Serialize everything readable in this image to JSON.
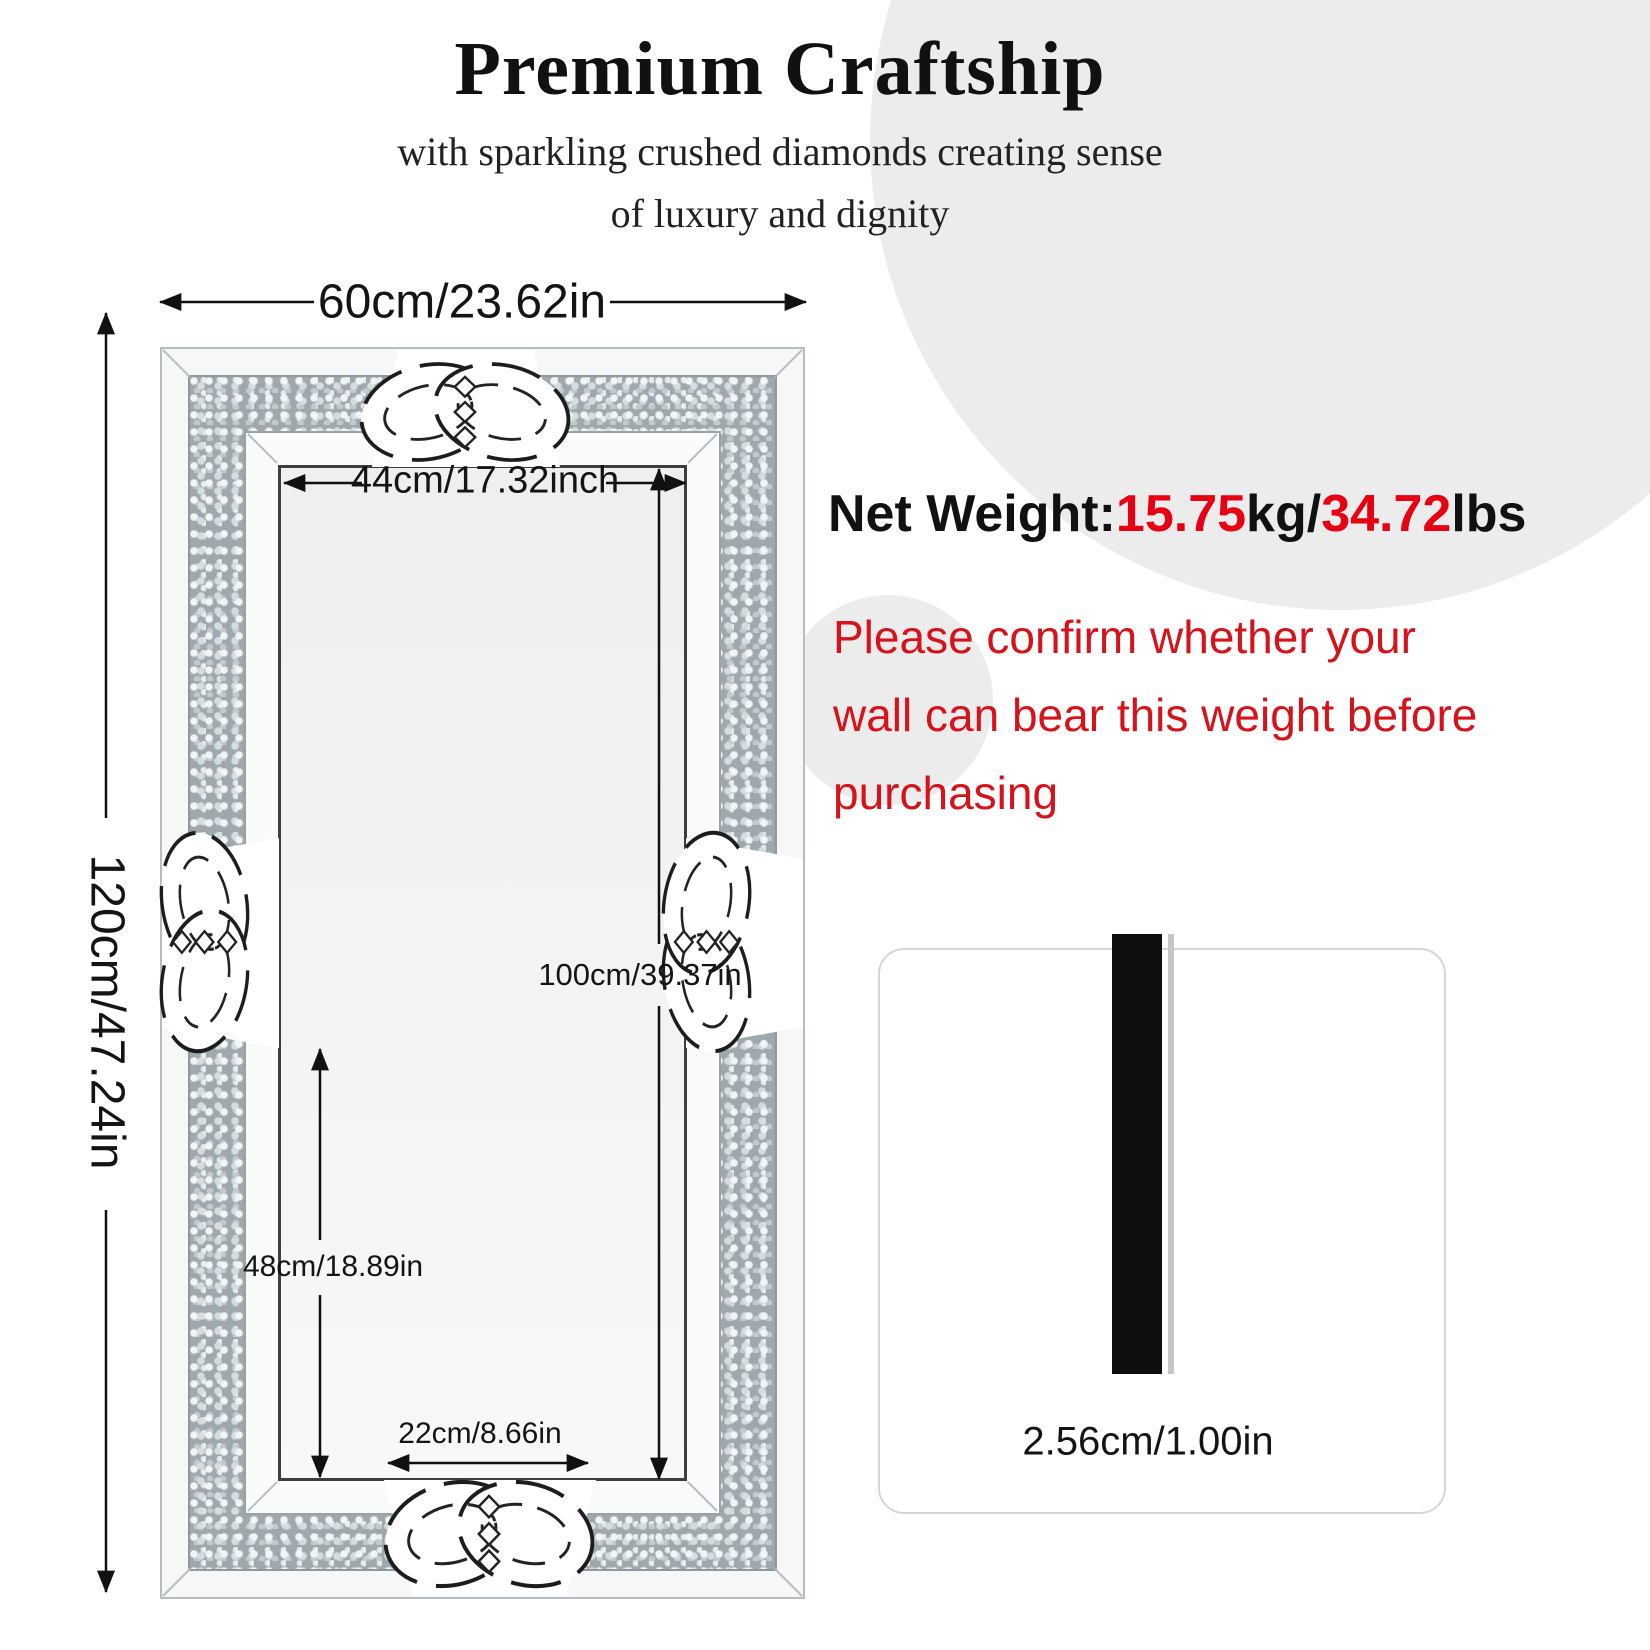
{
  "header": {
    "title": "Premium Craftship",
    "subtitle_line1": "with sparkling crushed diamonds creating sense",
    "subtitle_line2": "of luxury and dignity"
  },
  "weight": {
    "label": "Net Weight:",
    "kg_value": "15.75",
    "kg_unit": "kg/",
    "lbs_value": "34.72",
    "lbs_unit": "lbs"
  },
  "warning": {
    "lines": [
      "Please confirm whether your",
      "wall can bear this weight before",
      "purchasing"
    ]
  },
  "dimensions": {
    "outer_width": "60cm/23.62in",
    "outer_height": "120cm/47.24in",
    "inner_width": "44cm/17.32inch",
    "inner_height": "100cm/39.37in",
    "lower_height": "48cm/18.89in",
    "knot_width": "22cm/8.66in",
    "thickness": "2.56cm/1.00in"
  },
  "colors": {
    "accent_red": "#e60012",
    "warning_red": "#d6121b",
    "circle_gray": "#ececec",
    "line_black": "#111111"
  }
}
